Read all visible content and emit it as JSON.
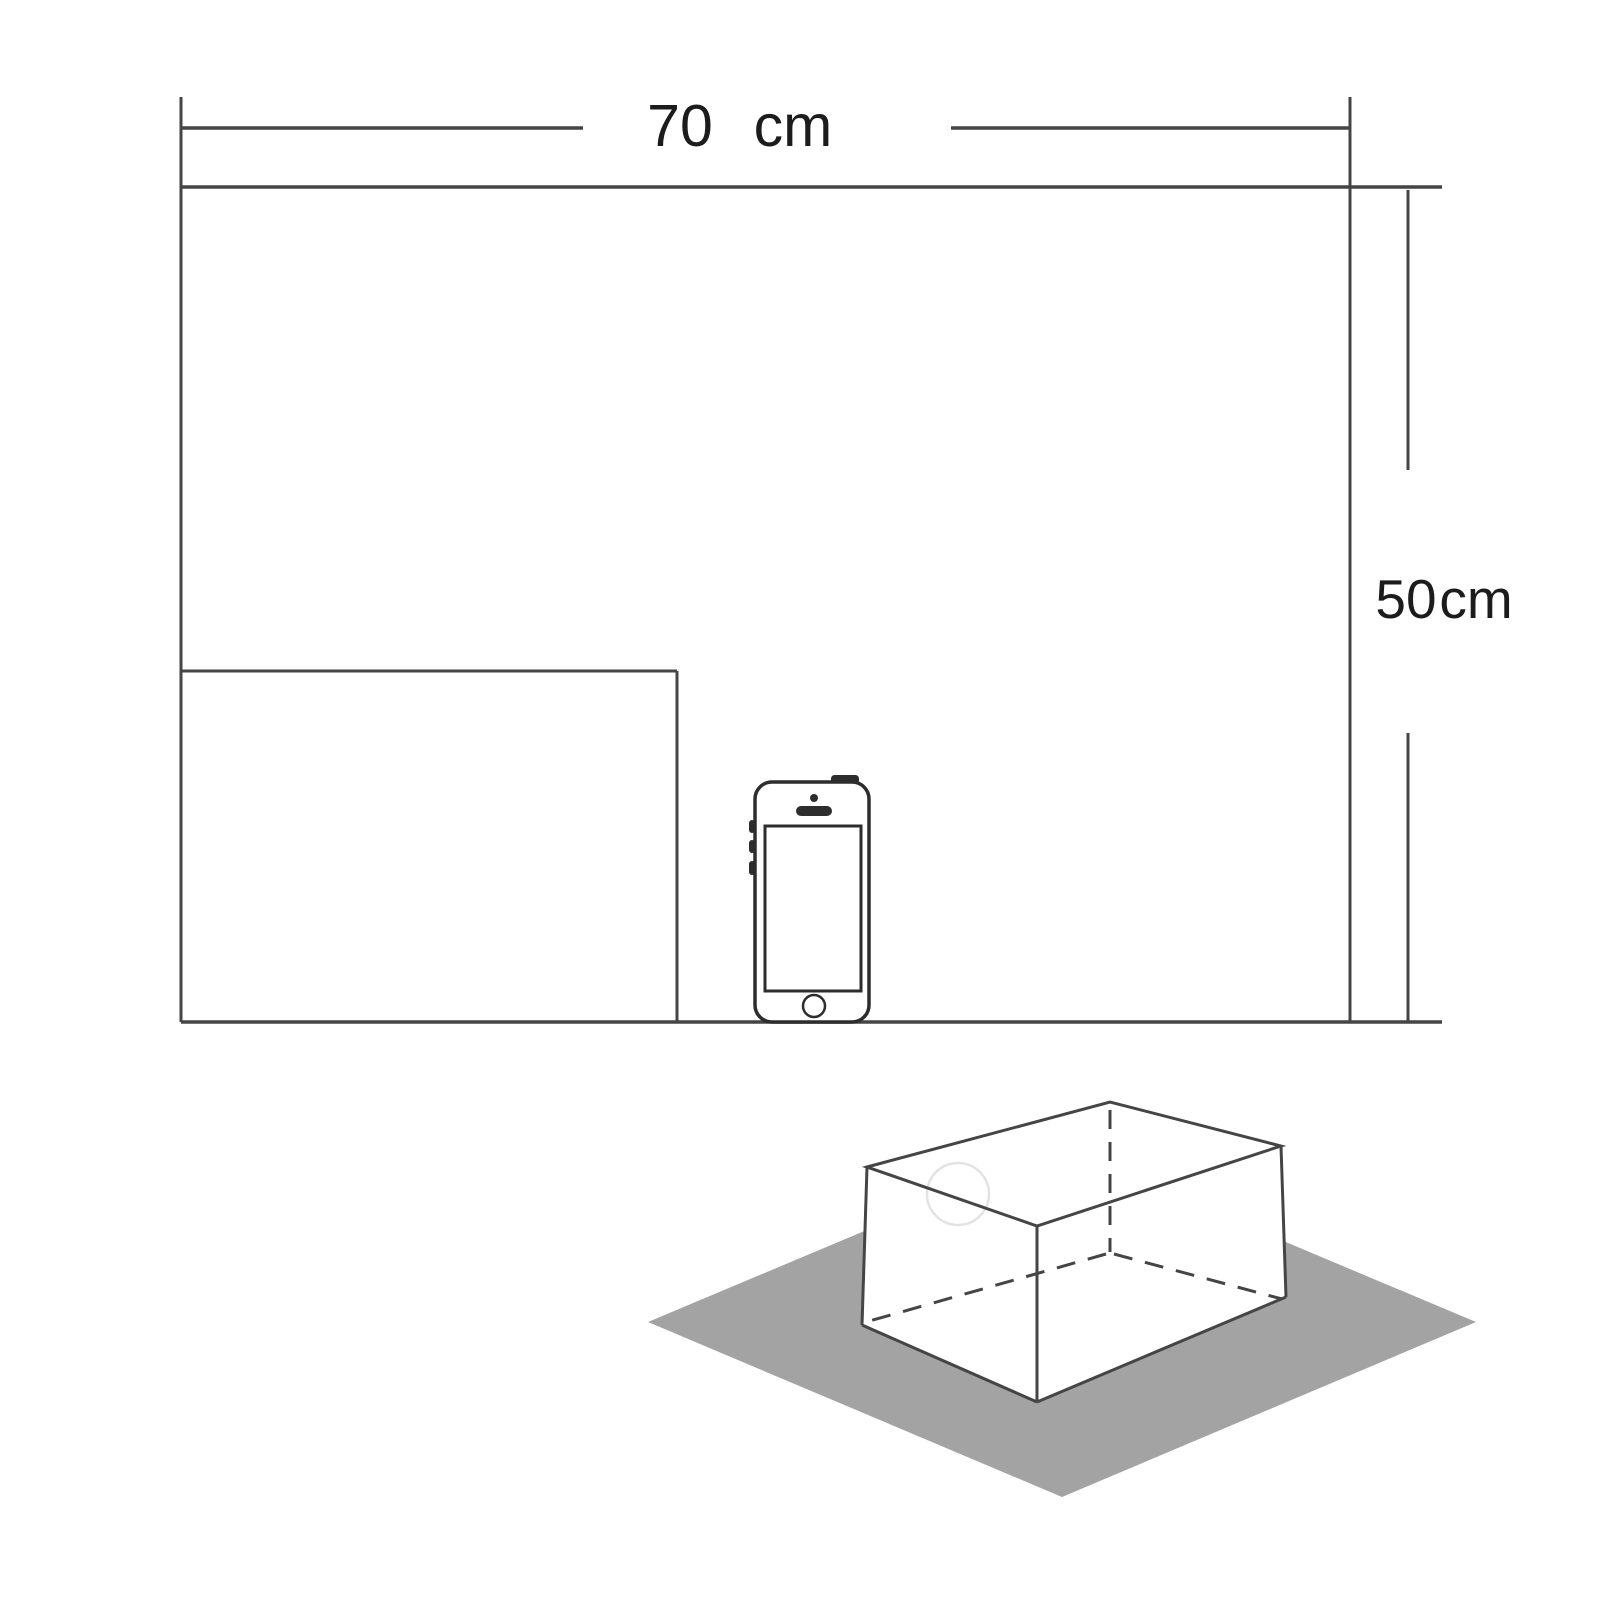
{
  "page": {
    "background": "#ffffff"
  },
  "colors": {
    "line": "#454545",
    "text": "#1c1c1c",
    "ground_plane": "#a3a3a3",
    "phone_outline": "#2d2d2d",
    "phone_fill": "#ffffff",
    "box_face": "#ffffff",
    "faint_circle": "#e3e3e3"
  },
  "dimensions": {
    "width": {
      "value": "70",
      "unit": "cm"
    },
    "height": {
      "value": "50",
      "unit": "cm"
    }
  },
  "icons": {
    "smartphone": "smartphone-icon",
    "ground": "ground-plane",
    "box": "wireframe-box-icon"
  }
}
